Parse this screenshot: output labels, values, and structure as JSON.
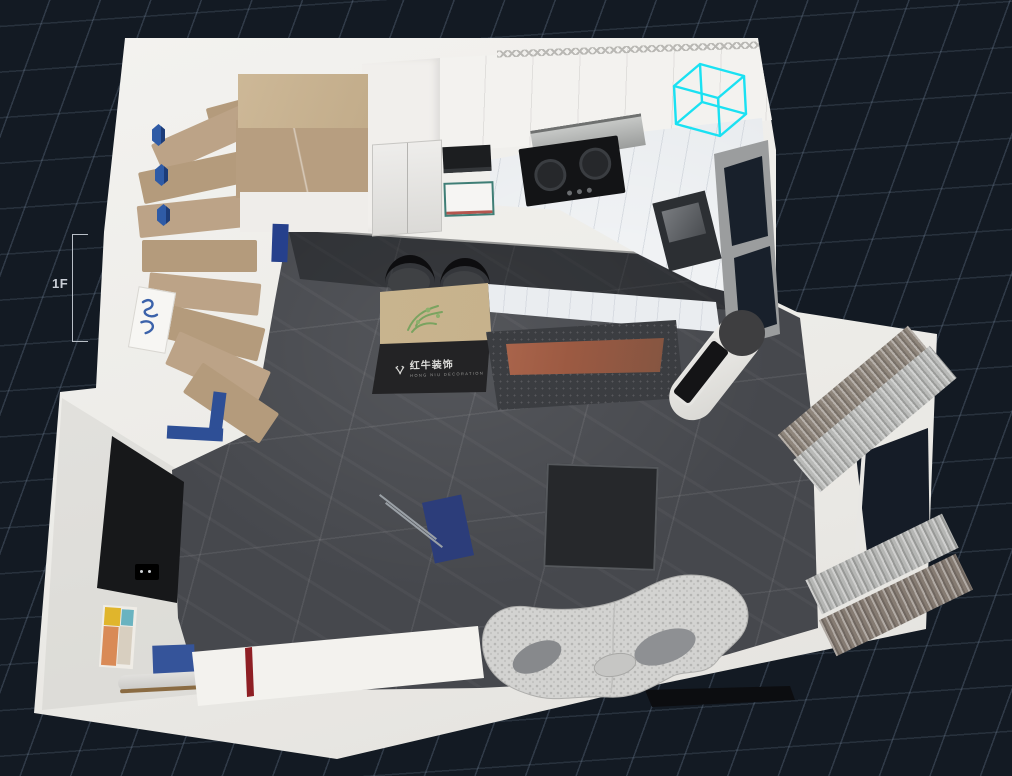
{
  "viewport": {
    "floor_label": "1F",
    "background_color": "#131a23",
    "grid_line_color": "#2e3945",
    "selection_color": "#1ae1f2",
    "wall_color": "#ecebe7",
    "floor_tile_color": "#46484d"
  },
  "watermark": {
    "logo_icon": "bull-logo-icon",
    "brand": "红牛装饰",
    "tagline": "HONG NIU DECORATION"
  },
  "scene": {
    "objects": [
      "staircase",
      "stair-landing",
      "wall-hexagon-decor",
      "wall-art",
      "refrigerator",
      "tall-cabinet",
      "upper-cabinets",
      "microwave",
      "glass-basin",
      "gas-cooktop",
      "range-hood",
      "wall-oven",
      "counter",
      "bar-counter",
      "kitchen-island",
      "island-plant",
      "bar-stool",
      "television",
      "tv-console",
      "coffee-table",
      "sofa",
      "floor-ac-unit",
      "window",
      "bay-window",
      "curtain",
      "tv-feature-wall",
      "painting",
      "bench",
      "blue-mat",
      "sideboard",
      "selection-cube"
    ]
  }
}
